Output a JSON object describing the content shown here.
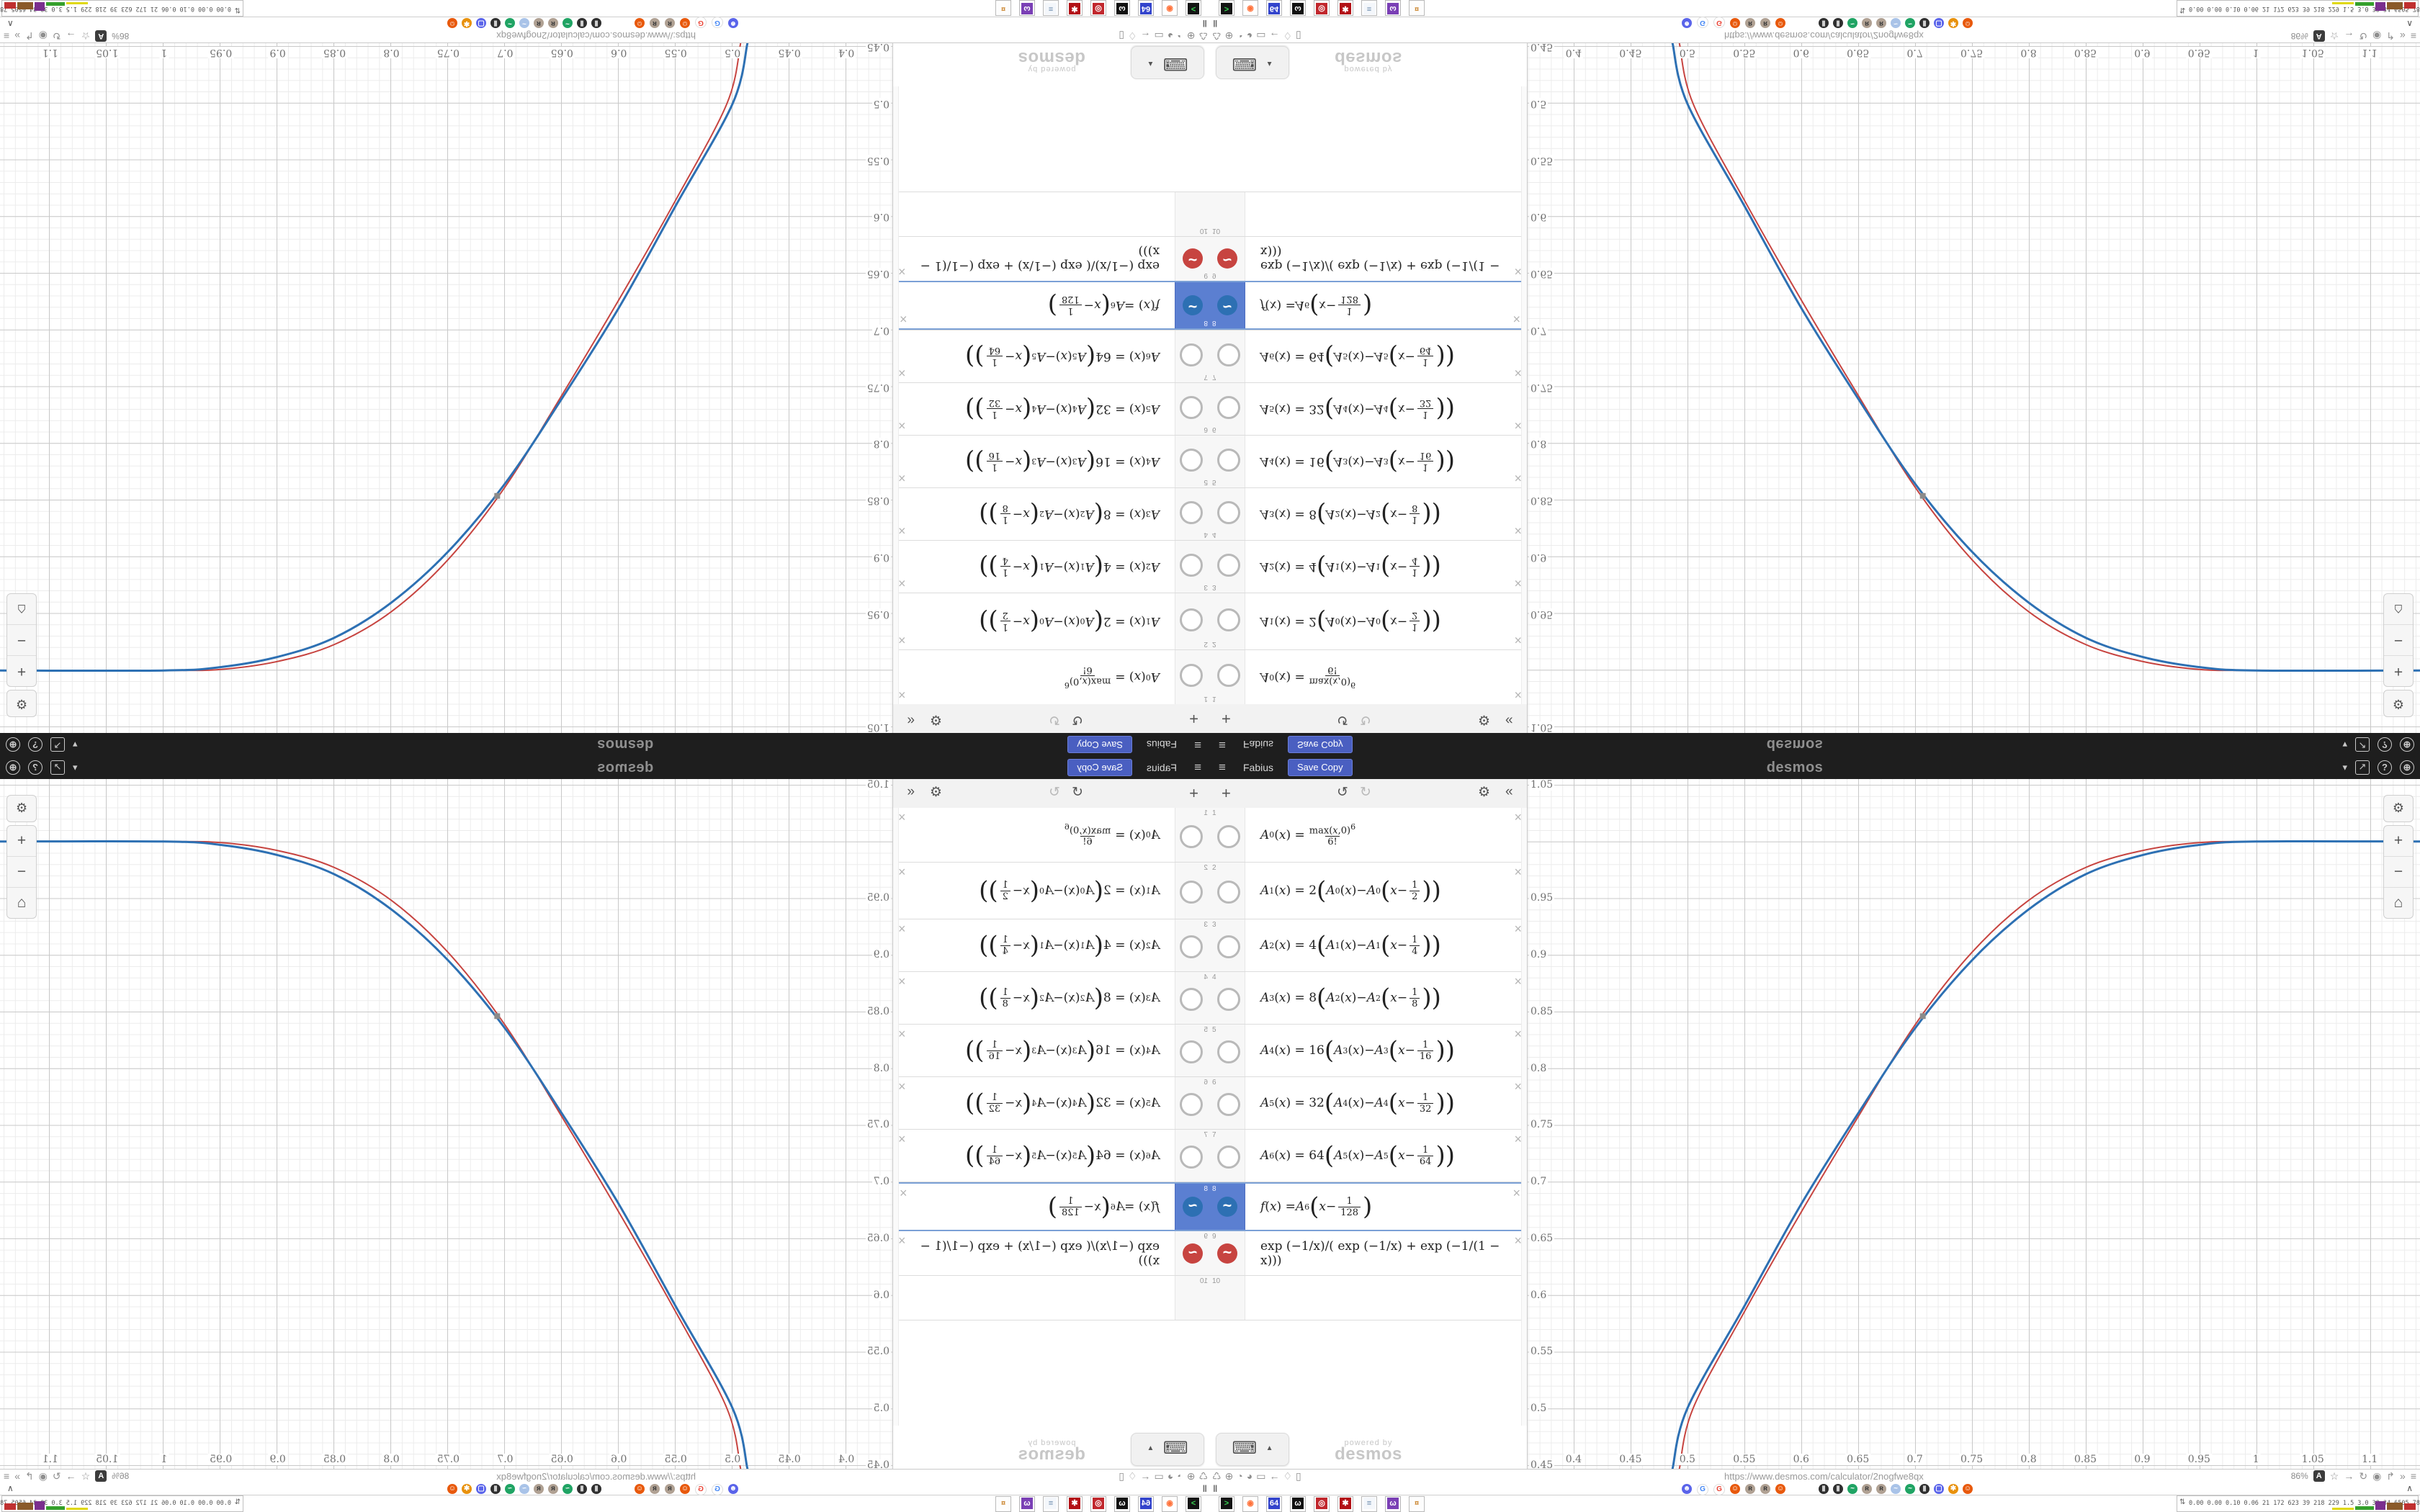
{
  "header": {
    "title": "Fabius",
    "save_copy_label": "Save Copy",
    "brand": "desmos",
    "menu_icon": "≡",
    "right_icons": [
      {
        "name": "caret-down-icon",
        "glyph": "▾",
        "style": "plain"
      },
      {
        "name": "export-icon",
        "glyph": "↗",
        "style": "boxed"
      },
      {
        "name": "help-icon",
        "glyph": "?",
        "style": "circ"
      },
      {
        "name": "globe-icon",
        "glyph": "⊕",
        "style": "circ"
      }
    ]
  },
  "toolbar": {
    "add_label": "+",
    "undo_label": "↺",
    "redo_label": "↻",
    "settings_label": "⚙",
    "collapse_label": "«"
  },
  "expressions": [
    {
      "n": "1",
      "kind": "base",
      "fn": "A",
      "sub": "0",
      "num": "max",
      "num_arg": "(x,0)",
      "num_exp": "6",
      "den": "6!",
      "h": 76
    },
    {
      "n": "2",
      "kind": "recur",
      "sub": "1",
      "coef": "2",
      "prev": "0",
      "den": "2",
      "h": 79
    },
    {
      "n": "3",
      "kind": "recur",
      "sub": "2",
      "coef": "4",
      "prev": "1",
      "den": "4",
      "h": 73
    },
    {
      "n": "4",
      "kind": "recur",
      "sub": "3",
      "coef": "8",
      "prev": "2",
      "den": "8",
      "h": 73
    },
    {
      "n": "5",
      "kind": "recur",
      "sub": "4",
      "coef": "16",
      "prev": "3",
      "den": "16",
      "h": 73
    },
    {
      "n": "6",
      "kind": "recur",
      "sub": "5",
      "coef": "32",
      "prev": "4",
      "den": "32",
      "h": 73
    },
    {
      "n": "7",
      "kind": "recur",
      "sub": "6",
      "coef": "64",
      "prev": "5",
      "den": "64",
      "h": 73
    },
    {
      "n": "8",
      "kind": "fdef",
      "fn": "f",
      "arg": "6",
      "den": "128",
      "selected": true,
      "color": "#2d70b3",
      "h": 68
    },
    {
      "n": "9",
      "kind": "plain",
      "text": "exp (−1/x)/( exp (−1/x) + exp (−1/(1 − x)))",
      "color": "#c74440",
      "h": 62
    },
    {
      "n": "10",
      "kind": "empty",
      "h": 62
    }
  ],
  "panel_footer": {
    "keyboard_icon": "⌨",
    "caret_icon": "▲",
    "powered_by": "powered by",
    "brand": "desmos"
  },
  "graph_controls": {
    "wrench": "⚙",
    "zoom_in": "+",
    "zoom_out": "−",
    "home": "⌂"
  },
  "chart_data": {
    "type": "line",
    "title": "Fabius function vs exponential smoothstep",
    "xlabel": "",
    "ylabel": "",
    "xlim": [
      0.3595,
      1.1442
    ],
    "ylim": [
      0.4467,
      1.0551
    ],
    "grid": "on",
    "x_ticks": [
      0.4,
      0.45,
      0.5,
      0.55,
      0.6,
      0.65,
      0.7,
      0.75,
      0.8,
      0.85,
      0.9,
      0.95,
      1,
      1.05,
      1.1
    ],
    "x_tick_labels": [
      "0.4",
      "0.45",
      "0.5",
      "0.55",
      "0.6",
      "0.65",
      "0.7",
      "0.75",
      "0.8",
      "0.85",
      "0.9",
      "0.95",
      "1",
      "1.05",
      "1.1"
    ],
    "y_ticks": [
      1.05,
      0.95,
      0.9,
      0.85,
      0.8,
      0.75,
      0.7,
      0.65,
      0.6,
      0.55,
      0.5,
      0.45
    ],
    "y_tick_labels": [
      "1.05",
      "0.95",
      "0.9",
      "0.85",
      "0.8",
      "0.75",
      "0.7",
      "0.65",
      "0.6",
      "0.55",
      "0.5",
      "0.45"
    ],
    "series": [
      {
        "name": "f(x) = A6(x − 1/128)",
        "color": "#2d70b3",
        "width": 3,
        "points": [
          [
            0.487,
            0.447
          ],
          [
            0.5,
            0.5
          ],
          [
            0.55,
            0.59
          ],
          [
            0.6,
            0.68
          ],
          [
            0.65,
            0.76
          ],
          [
            0.7,
            0.835
          ],
          [
            0.75,
            0.895
          ],
          [
            0.8,
            0.94
          ],
          [
            0.85,
            0.971
          ],
          [
            0.9,
            0.988
          ],
          [
            0.95,
            0.997
          ],
          [
            1.0,
            1.0
          ],
          [
            1.1442,
            1.0
          ]
        ]
      },
      {
        "name": "exp(−1/x)/(exp(−1/x)+exp(−1/(1−x)))",
        "color": "#c74440",
        "width": 2,
        "points": [
          [
            0.493,
            0.447
          ],
          [
            0.505,
            0.5
          ],
          [
            0.55,
            0.585
          ],
          [
            0.6,
            0.673
          ],
          [
            0.65,
            0.757
          ],
          [
            0.7,
            0.838
          ],
          [
            0.75,
            0.902
          ],
          [
            0.8,
            0.948
          ],
          [
            0.85,
            0.977
          ],
          [
            0.9,
            0.992
          ],
          [
            0.95,
            0.999
          ],
          [
            1.0,
            1.0
          ],
          [
            1.1442,
            1.0
          ]
        ]
      }
    ],
    "marker": {
      "x": 0.707,
      "y": 0.846,
      "color": "#8a8a8a"
    }
  },
  "browser": {
    "status_left_icons": [
      {
        "name": "trash-icon",
        "glyph": "♺"
      },
      {
        "name": "globe-icon",
        "glyph": "⊕"
      },
      {
        "name": "gauge-icon",
        "glyph": "◔"
      },
      {
        "name": "gauge-icon",
        "glyph": "◕"
      },
      {
        "name": "folder-icon",
        "glyph": "▭"
      },
      {
        "name": "back-arrow-icon",
        "glyph": "←"
      },
      {
        "name": "shield-icon",
        "glyph": "♢"
      },
      {
        "name": "lock-icon",
        "glyph": "▯"
      }
    ],
    "status_url": "https://www.desmos.com/calculator/2nogfwe8qx",
    "zoom_level": "86%",
    "status_right_icons": [
      {
        "name": "star-icon",
        "glyph": "☆"
      },
      {
        "name": "forward-arrow-icon",
        "glyph": "→"
      },
      {
        "name": "reload-icon",
        "glyph": "↻"
      },
      {
        "name": "globe-dark-icon",
        "glyph": "◉"
      },
      {
        "name": "share-icon",
        "glyph": "↱"
      },
      {
        "name": "chevrons-icon",
        "glyph": "»"
      },
      {
        "name": "menu-icon",
        "glyph": "≡"
      }
    ],
    "translate_icon": "A",
    "pause_icon": "‖",
    "tab_collapse_icon": "∧",
    "favicons_group1": [
      {
        "name": "discord-favicon",
        "bg": "#5a64ea",
        "fg": "#ffffff",
        "glyph": "☻"
      },
      {
        "name": "google-favicon",
        "bg": "#ffffff",
        "fg": "#4285f4",
        "glyph": "G"
      },
      {
        "name": "google-favicon",
        "bg": "#ffffff",
        "fg": "#ea4335",
        "glyph": "G"
      },
      {
        "name": "emoji-face-favicon",
        "bg": "#e8590c",
        "fg": "#ffffff",
        "glyph": "☺"
      },
      {
        "name": "raccoon-favicon",
        "bg": "#b0a193",
        "fg": "#3a3a3a",
        "glyph": "ʀ"
      },
      {
        "name": "raccoon-favicon",
        "bg": "#b0a193",
        "fg": "#3a3a3a",
        "glyph": "ʀ"
      },
      {
        "name": "emoji-face-favicon",
        "bg": "#e8590c",
        "fg": "#ffffff",
        "glyph": "☺"
      }
    ],
    "favicons_group2": [
      {
        "name": "bin-favicon",
        "bg": "#2f2f2f",
        "fg": "#cfcfcf",
        "glyph": "▮"
      },
      {
        "name": "bin-favicon",
        "bg": "#2f2f2f",
        "fg": "#cfcfcf",
        "glyph": "▮"
      },
      {
        "name": "desmos-favicon",
        "bg": "#20a464",
        "fg": "#ffffff",
        "glyph": "~"
      },
      {
        "name": "raccoon-favicon",
        "bg": "#b0a193",
        "fg": "#3a3a3a",
        "glyph": "ʀ"
      },
      {
        "name": "raccoon-favicon",
        "bg": "#b0a193",
        "fg": "#3a3a3a",
        "glyph": "ʀ"
      },
      {
        "name": "bird-favicon",
        "bg": "#a9c3e8",
        "fg": "#ffffff",
        "glyph": "~"
      },
      {
        "name": "desmos-favicon",
        "bg": "#20a464",
        "fg": "#ffffff",
        "glyph": "~"
      },
      {
        "name": "bin-favicon",
        "bg": "#2f2f2f",
        "fg": "#cfcfcf",
        "glyph": "▮"
      },
      {
        "name": "chat-favicon",
        "bg": "#5a64ea",
        "fg": "#ffffff",
        "glyph": "▢"
      },
      {
        "name": "sun-gear-favicon",
        "bg": "#e8910c",
        "fg": "#ffffff",
        "glyph": "✱"
      },
      {
        "name": "emoji-face-favicon",
        "bg": "#e8590c",
        "fg": "#ffffff",
        "glyph": "☺"
      }
    ],
    "taskbar_icons": [
      {
        "name": "terminal-app-icon",
        "bg": "#141414",
        "fg": "#39d353",
        "glyph": ">"
      },
      {
        "name": "firefox-app-icon",
        "bg": "#ffffff",
        "fg": "#ff7139",
        "glyph": "◉"
      },
      {
        "name": "floppy64-app-icon",
        "bg": "#3344cc",
        "fg": "#ffffff",
        "glyph": "64"
      },
      {
        "name": "cat-bw-app-icon",
        "bg": "#111111",
        "fg": "#ffffff",
        "glyph": "ω"
      },
      {
        "name": "red-disc-app-icon",
        "bg": "#c1272d",
        "fg": "#ffffff",
        "glyph": "◎"
      },
      {
        "name": "red-gear-app-icon",
        "bg": "#b31217",
        "fg": "#ffffff",
        "glyph": "✱"
      },
      {
        "name": "notepad-app-icon",
        "bg": "#f4f7fb",
        "fg": "#6688aa",
        "glyph": "≡"
      },
      {
        "name": "purple-cat-app-icon",
        "bg": "#7a3fb5",
        "fg": "#ffffff",
        "glyph": "ω"
      },
      {
        "name": "palette-app-icon",
        "bg": "#fdfdfd",
        "fg": "#cc8833",
        "glyph": "¤"
      }
    ],
    "monitor": {
      "icon": "⇅",
      "values": [
        "0.00",
        "0.00",
        "0.10",
        "0.06",
        "21",
        "172",
        "623",
        "39",
        "218",
        "229",
        "1.5",
        "3.0",
        "39",
        "34",
        "6505",
        "7819"
      ],
      "sparkline_colors": [
        "#e0d80a",
        "#35a02c",
        "#7a2f8e",
        "#8a5a2a",
        "#c03030"
      ]
    }
  },
  "colors": {
    "header_bg": "#1e1e1e",
    "accent_button": "#4a5fc1",
    "selected_row": "#5b7fd1",
    "curve_blue": "#2d70b3",
    "curve_red": "#c74440"
  }
}
